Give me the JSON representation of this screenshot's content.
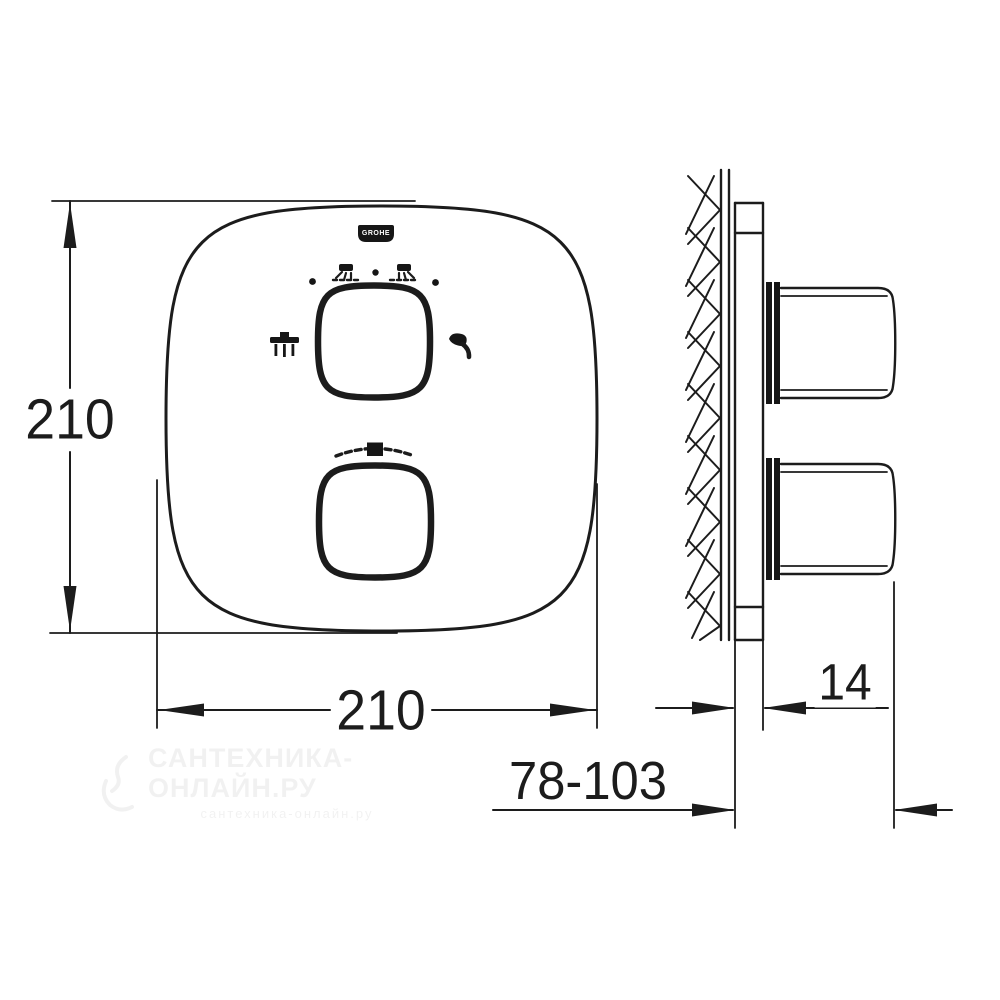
{
  "drawing": {
    "description": "technical-dimension-drawing-thermostatic-shower-trim",
    "colors": {
      "line": "#1c1c1c",
      "background": "#ffffff",
      "watermark": "#ebebeb"
    },
    "dimensions": {
      "plate_height_mm": "210",
      "plate_width_mm": "210",
      "plate_thickness_mm": "14",
      "projection_range_mm": "78-103"
    },
    "logo": {
      "text": "GROHE"
    },
    "icons": {
      "left_of_top_knob": "overhead-shower",
      "right_of_top_knob": "hand-shower",
      "above_top_knob_left": "spray-pattern",
      "above_top_knob_right": "spray-pattern",
      "above_bottom_knob": "temperature-scale"
    }
  },
  "watermark": {
    "line1": "САНТЕХНИКА-ОНЛАЙН.РУ",
    "line2": "сантехника-онлайн.ру"
  }
}
